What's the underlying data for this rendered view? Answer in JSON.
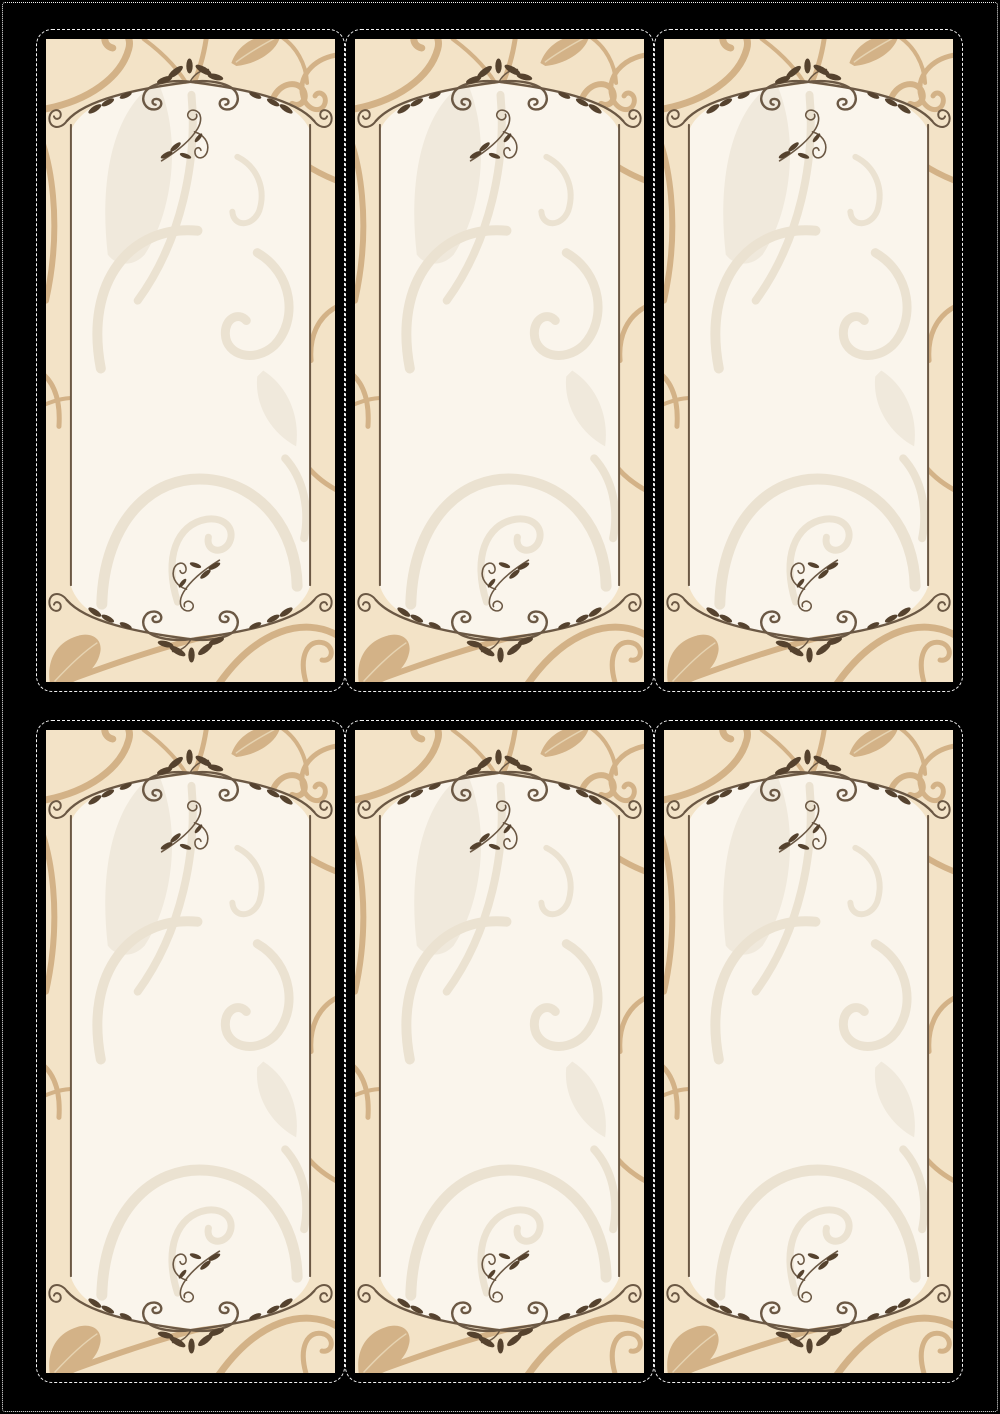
{
  "sheet": {
    "rows": 2,
    "columns": 3,
    "panel_count": 6,
    "panels": [
      {
        "label": ""
      },
      {
        "label": ""
      },
      {
        "label": ""
      },
      {
        "label": ""
      },
      {
        "label": ""
      },
      {
        "label": ""
      }
    ],
    "motifs": [
      "scroll-frame",
      "leaf-sprig",
      "vine-swirl",
      "corner-leaf"
    ]
  },
  "colors": {
    "page-bg": "#000000",
    "cut-line": "#f2f2f2",
    "beige": "#f3e3c7",
    "tan": "#d3b287",
    "tan-rib": "#e6d3b1",
    "cream": "#faf5ec",
    "light-line": "#ebe2d1",
    "light-fill": "#f0e9dc",
    "frame": "#6b5844",
    "dark-leaf": "#55422e"
  }
}
